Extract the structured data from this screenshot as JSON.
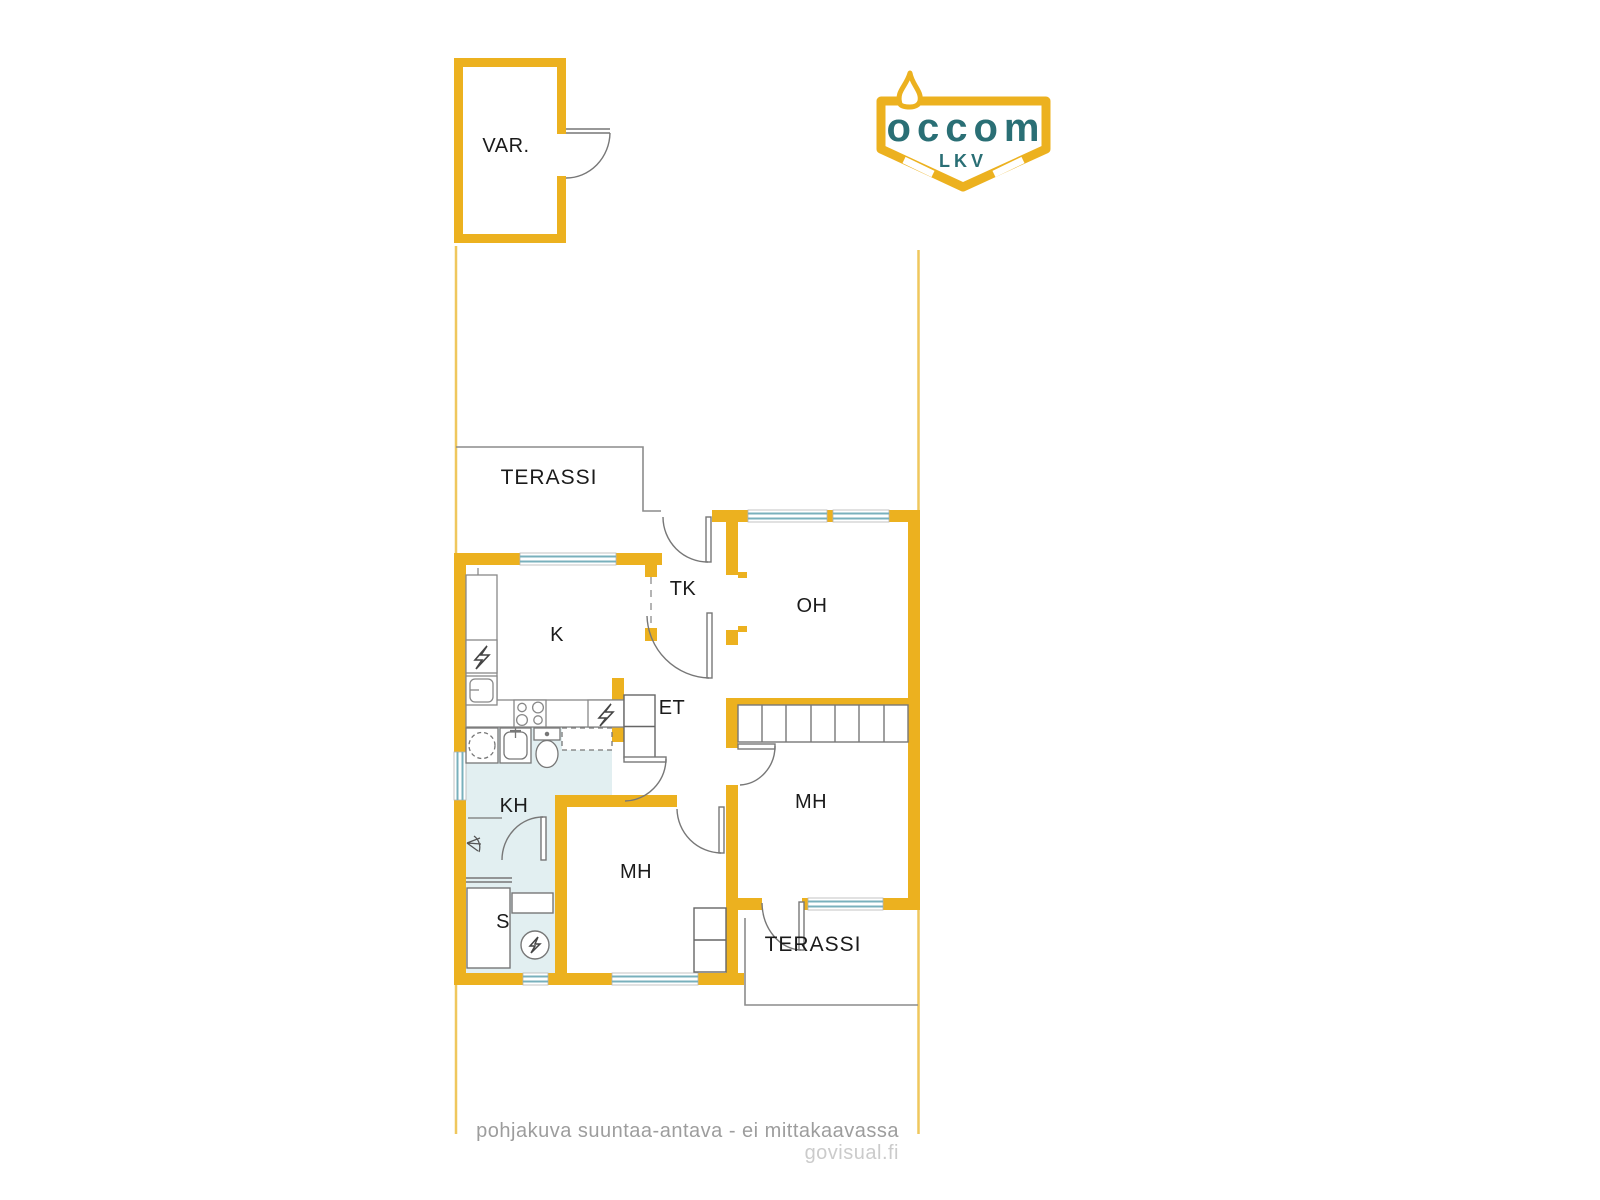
{
  "page": {
    "background": "#ffffff"
  },
  "colors": {
    "wall_yellow": "#ECB11F",
    "boundary_yellow": "#EFC75D",
    "window_glass_teal": "#79B0BC",
    "wet_room_floor": "#E2EFF1",
    "outline_gray": "#8C8C8C",
    "label_black": "#1B1B1B",
    "logo_teal": "#2A6F75"
  },
  "logo": {
    "brand": "occom",
    "subtitle": "LKV"
  },
  "rooms": {
    "storage": "VAR.",
    "terrace_top": "TERASSI",
    "kitchen": "K",
    "vestibule": "TK",
    "living_room": "OH",
    "hall": "ET",
    "bathroom": "KH",
    "bedroom_middle": "MH",
    "bedroom_right": "MH",
    "sauna": "S",
    "terrace_bottom": "TERASSI"
  },
  "footer": {
    "disclaimer": "pohjakuva suuntaa-antava - ei mittakaavassa",
    "credit": "govisual.fi"
  }
}
